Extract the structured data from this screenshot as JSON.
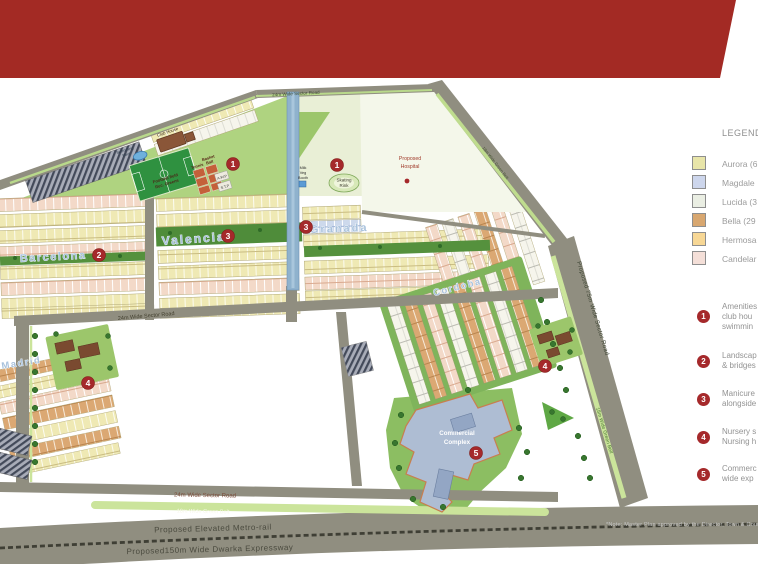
{
  "banner": {
    "color": "#A32A24"
  },
  "legend": {
    "title": "LEGEND",
    "items": [
      {
        "label": "Aurora (6",
        "color": "#E8E5A9"
      },
      {
        "label": "Magdale",
        "color": "#CDD6EC"
      },
      {
        "label": "Lucida (3",
        "color": "#EAEEE3"
      },
      {
        "label": "Bella (29",
        "color": "#D8A770"
      },
      {
        "label": "Hermosa",
        "color": "#F7D795"
      },
      {
        "label": "Candelar",
        "color": "#F4DFD8"
      }
    ],
    "marker_color": "#A5292B",
    "notes": [
      {
        "n": "1",
        "lines": [
          "Amenities",
          "club hou",
          "swimmin"
        ]
      },
      {
        "n": "2",
        "lines": [
          "Landscap",
          "& bridges"
        ]
      },
      {
        "n": "3",
        "lines": [
          "Manicure",
          "alongside"
        ]
      },
      {
        "n": "4",
        "lines": [
          "Nursery s",
          "Nursing h"
        ]
      },
      {
        "n": "5",
        "lines": [
          "Commerc",
          "wide exp"
        ]
      }
    ]
  },
  "footnote": "*Note: Master Plan approved by the Director, Town & Country P",
  "map": {
    "districts": [
      {
        "name": "Barcelona"
      },
      {
        "name": "Valencia"
      },
      {
        "name": "Granada"
      },
      {
        "name": "Cordoba"
      },
      {
        "name": "Madrid"
      }
    ],
    "pois": {
      "hospital": [
        "Proposed",
        "Hospital"
      ],
      "skating": [
        "Skating",
        "Rink"
      ],
      "club_house": "Club House",
      "swimming_pool": [
        "Swimming",
        "Pool"
      ],
      "football": [
        "Football field",
        "Rec. Greens"
      ],
      "tennis": "Tennis",
      "basketball": [
        "Basket",
        "Ball"
      ],
      "milk_booth": [
        "Milk",
        "Veg",
        "Booth"
      ],
      "awp": "A.W.P",
      "stp": "S.T.P",
      "commercial": [
        "Commercial",
        "Complex"
      ]
    },
    "roads": {
      "top": "24m Wide Sector Road",
      "mid": "24m Wide Sector Road",
      "bottom": "24m Wide Sector Road",
      "right": "Proposed 75m Wide Sector Road",
      "diag_green": "18m Wide Green Belt",
      "belt_bottom": "18m Wide Green Belt",
      "belt_right": "18m Wide Green Belt",
      "metro": "Proposed Elevated Metro-rail",
      "expressway": "Proposed150m Wide Dwarka Expressway"
    },
    "markers": [
      {
        "n": "1"
      },
      {
        "n": "1"
      },
      {
        "n": "2"
      },
      {
        "n": "3"
      },
      {
        "n": "3"
      },
      {
        "n": "4"
      },
      {
        "n": "4"
      },
      {
        "n": "5"
      }
    ]
  }
}
